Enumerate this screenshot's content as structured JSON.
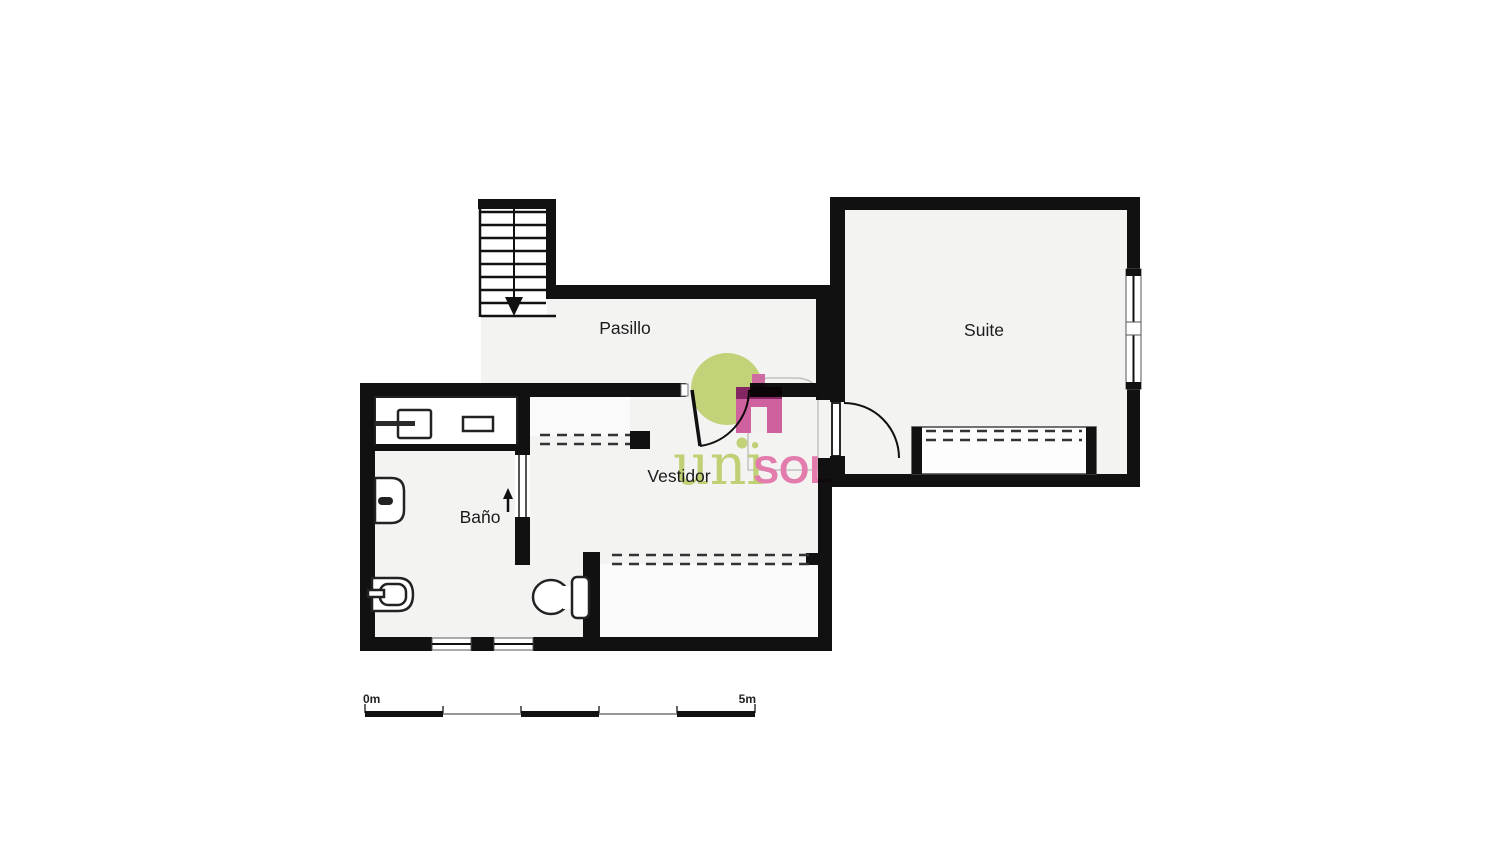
{
  "title": "Floor plan",
  "rooms": [
    {
      "id": "pasillo",
      "label": "Pasillo"
    },
    {
      "id": "suite",
      "label": "Suite"
    },
    {
      "id": "vestidor",
      "label": "Vestidor"
    },
    {
      "id": "bano",
      "label": "Baño"
    }
  ],
  "scale_bar": {
    "start_label": "0m",
    "end_label": "5m",
    "meters": 5
  },
  "brand": {
    "part1": "uni",
    "part2": "SOL"
  },
  "icons": {
    "stair_down_arrow": "filled triangle pointing down",
    "entry_arrow": "small arrow pointing up at bathroom entrance",
    "logo_house": "pink house glyph with white doorway",
    "logo_circle": "yellow-green circle"
  },
  "colors": {
    "wall": "#111111",
    "room_fill": "#f3f3f2",
    "background": "#ffffff",
    "logo_green": "#c7da72",
    "logo_pink_body": "#d6569d",
    "logo_dark_magenta": "#7c1056",
    "brand_green_text": "#c5d76d",
    "brand_pink_text": "#ee74ae"
  }
}
